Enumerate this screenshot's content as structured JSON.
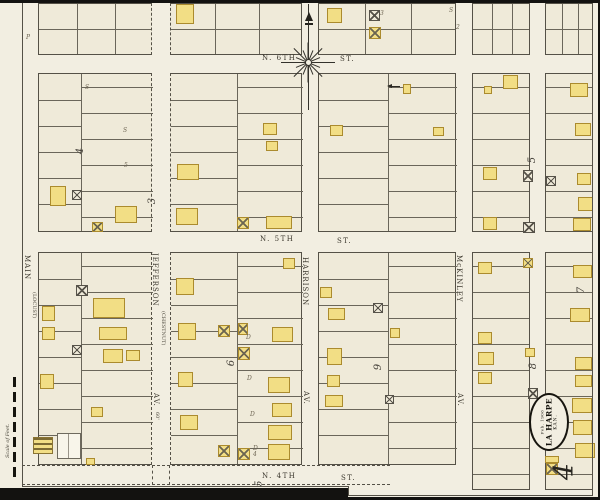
{
  "map_type": "sanborn-fire-insurance-plat",
  "stamp": {
    "date": "Feb. 1906",
    "city": "LA HARPE",
    "state": "KAN."
  },
  "sheet_number": "4",
  "adjoining_sheet_number": "5",
  "scale_label": "Scale of Feet.",
  "streets": {
    "horizontal": [
      "N. 6th St.",
      "N. 5th St.",
      "N. 4th St."
    ],
    "vertical": [
      "Main (Locust)",
      "Jefferson (Chestnut) Av. 60'",
      "Harrison Av.",
      "McKinley Av."
    ]
  },
  "block_numbers_visible": [
    "2",
    "3",
    "4",
    "5",
    "6",
    "7",
    "8",
    "9"
  ],
  "colors": {
    "paper": "#f2eee1",
    "block_fill": "#efead9",
    "line": "#555147",
    "building_yellow": "#f2de85",
    "building_border": "#ab8b2e",
    "ink": "#3b372d",
    "scan_edge": "#131210"
  },
  "labels": [
    {
      "t": "N. 6TH",
      "x": 262,
      "y": 55,
      "cls": "sh",
      "n": "street-label-n-6th"
    },
    {
      "t": "ST.",
      "x": 340,
      "y": 56,
      "cls": "sh",
      "n": "street-label-n-6th-st"
    },
    {
      "t": "N. 5TH",
      "x": 260,
      "y": 236,
      "cls": "sh",
      "n": "street-label-n-5th"
    },
    {
      "t": "ST.",
      "x": 337,
      "y": 238,
      "cls": "sh",
      "n": "street-label-n-5th-st"
    },
    {
      "t": "N. 4TH",
      "x": 262,
      "y": 473,
      "cls": "sh",
      "n": "street-label-n-4th"
    },
    {
      "t": "ST.",
      "x": 341,
      "y": 475,
      "cls": "sh",
      "n": "street-label-n-4th-st"
    },
    {
      "t": "MAIN",
      "x": 23,
      "y": 255,
      "cls": "sv",
      "n": "street-label-main"
    },
    {
      "t": "(LOCUST)",
      "x": 31,
      "y": 292,
      "cls": "sv alt",
      "n": "street-label-main-former"
    },
    {
      "t": "JEFFERSON",
      "x": 151,
      "y": 253,
      "cls": "sv",
      "n": "street-label-jefferson"
    },
    {
      "t": "(CHESTNUT)",
      "x": 160,
      "y": 311,
      "cls": "sv alt",
      "n": "street-label-jefferson-former"
    },
    {
      "t": "AV.",
      "x": 152,
      "y": 393,
      "cls": "sv",
      "n": "street-label-jefferson-av"
    },
    {
      "t": "60'",
      "x": 154,
      "y": 412,
      "cls": "sv alt",
      "n": "street-width-60ft"
    },
    {
      "t": "HARRISON",
      "x": 301,
      "y": 257,
      "cls": "sv",
      "n": "street-label-harrison"
    },
    {
      "t": "AV.",
      "x": 302,
      "y": 391,
      "cls": "sv",
      "n": "street-label-harrison-av"
    },
    {
      "t": "McKINLEY",
      "x": 455,
      "y": 255,
      "cls": "sv",
      "n": "street-label-mckinley"
    },
    {
      "t": "AV.",
      "x": 456,
      "y": 393,
      "cls": "sv",
      "n": "street-label-mckinley-av"
    },
    {
      "t": "4",
      "x": 78,
      "y": 146,
      "cls": "bn",
      "n": "block-number-4"
    },
    {
      "t": "3",
      "x": 150,
      "y": 196,
      "cls": "bn",
      "n": "block-number-3"
    },
    {
      "t": "5",
      "x": 530,
      "y": 155,
      "cls": "bn",
      "n": "block-number-5"
    },
    {
      "t": "6",
      "x": 229,
      "y": 358,
      "cls": "bn",
      "n": "block-number-6"
    },
    {
      "t": "9",
      "x": 376,
      "y": 362,
      "cls": "bn",
      "n": "block-number-9"
    },
    {
      "t": "7",
      "x": 579,
      "y": 285,
      "cls": "bn",
      "n": "block-number-7"
    },
    {
      "t": "8",
      "x": 531,
      "y": 361,
      "cls": "bn",
      "n": "block-number-8"
    },
    {
      "t": "S",
      "x": 85,
      "y": 85,
      "cls": "an",
      "n": "lot-letter-s"
    },
    {
      "t": "S",
      "x": 123,
      "y": 128,
      "cls": "an",
      "n": "lot-letter-s"
    },
    {
      "t": "S",
      "x": 449,
      "y": 8,
      "cls": "an",
      "n": "lot-letter-s"
    },
    {
      "t": "P",
      "x": 26,
      "y": 35,
      "cls": "an",
      "n": "lot-letter-p"
    },
    {
      "t": "D",
      "x": 246,
      "y": 335,
      "cls": "an",
      "n": "dwelling-mark"
    },
    {
      "t": "D",
      "x": 247,
      "y": 376,
      "cls": "an",
      "n": "dwelling-mark"
    },
    {
      "t": "D",
      "x": 250,
      "y": 412,
      "cls": "an",
      "n": "dwelling-mark"
    },
    {
      "t": "D",
      "x": 253,
      "y": 446,
      "cls": "an",
      "n": "dwelling-mark"
    },
    {
      "t": "3",
      "x": 380,
      "y": 11,
      "cls": "an",
      "n": "lot-number"
    },
    {
      "t": "2",
      "x": 456,
      "y": 25,
      "cls": "an",
      "n": "lot-number"
    },
    {
      "t": "4",
      "x": 253,
      "y": 452,
      "cls": "an",
      "n": "lot-number"
    },
    {
      "t": "5",
      "x": 124,
      "y": 163,
      "cls": "an",
      "n": "lot-number"
    }
  ],
  "blocks": [
    {
      "x": 38,
      "y": 3,
      "w": 114,
      "h": 52,
      "kind": "top",
      "dr": true
    },
    {
      "x": 170,
      "y": 3,
      "w": 132,
      "h": 52,
      "kind": "top",
      "dl": true
    },
    {
      "x": 318,
      "y": 3,
      "w": 138,
      "h": 52,
      "kind": "top"
    },
    {
      "x": 472,
      "y": 3,
      "w": 58,
      "h": 52,
      "kind": "top"
    },
    {
      "x": 545,
      "y": 3,
      "w": 48,
      "h": 52,
      "kind": "top"
    },
    {
      "x": 38,
      "y": 73,
      "w": 114,
      "h": 159,
      "kind": "tall",
      "alley": true,
      "ax": 42,
      "dr": true
    },
    {
      "x": 170,
      "y": 73,
      "w": 132,
      "h": 159,
      "kind": "tall",
      "alley": true,
      "dl": true
    },
    {
      "x": 318,
      "y": 73,
      "w": 138,
      "h": 159,
      "kind": "tall",
      "alley": true
    },
    {
      "x": 472,
      "y": 73,
      "w": 58,
      "h": 159,
      "kind": "tall"
    },
    {
      "x": 545,
      "y": 73,
      "w": 48,
      "h": 159,
      "kind": "tall"
    },
    {
      "x": 38,
      "y": 252,
      "w": 114,
      "h": 213,
      "kind": "tall",
      "alley": true,
      "ax": 42,
      "dr": true
    },
    {
      "x": 170,
      "y": 252,
      "w": 132,
      "h": 213,
      "kind": "tall",
      "alley": true,
      "dl": true
    },
    {
      "x": 318,
      "y": 252,
      "w": 138,
      "h": 213,
      "kind": "tall",
      "alley": true
    },
    {
      "x": 472,
      "y": 252,
      "w": 58,
      "h": 238,
      "kind": "tall"
    },
    {
      "x": 545,
      "y": 252,
      "w": 48,
      "h": 238,
      "kind": "tall"
    }
  ],
  "buildings": [
    [
      176,
      4,
      18,
      20,
      "f"
    ],
    [
      327,
      8,
      15,
      15,
      "f"
    ],
    [
      369,
      10,
      11,
      11,
      "xb"
    ],
    [
      369,
      27,
      12,
      12,
      "fx"
    ],
    [
      50,
      186,
      16,
      20,
      "f"
    ],
    [
      72,
      190,
      10,
      10,
      "xb"
    ],
    [
      92,
      222,
      11,
      10,
      "fx"
    ],
    [
      115,
      206,
      22,
      17,
      "f"
    ],
    [
      177,
      164,
      22,
      16,
      "f"
    ],
    [
      176,
      208,
      22,
      17,
      "f"
    ],
    [
      263,
      123,
      14,
      12,
      "f"
    ],
    [
      266,
      141,
      12,
      10,
      "f"
    ],
    [
      237,
      217,
      12,
      12,
      "fx"
    ],
    [
      266,
      216,
      26,
      13,
      "f"
    ],
    [
      330,
      125,
      13,
      11,
      "f"
    ],
    [
      403,
      84,
      8,
      10,
      "f"
    ],
    [
      433,
      127,
      11,
      9,
      "f"
    ],
    [
      483,
      167,
      14,
      13,
      "f"
    ],
    [
      483,
      217,
      14,
      13,
      "f"
    ],
    [
      503,
      75,
      15,
      14,
      "f"
    ],
    [
      484,
      86,
      8,
      8,
      "f"
    ],
    [
      523,
      170,
      10,
      12,
      "xb"
    ],
    [
      523,
      222,
      12,
      11,
      "xb"
    ],
    [
      546,
      176,
      10,
      10,
      "xb"
    ],
    [
      575,
      123,
      16,
      13,
      "f"
    ],
    [
      577,
      173,
      14,
      12,
      "f"
    ],
    [
      578,
      197,
      15,
      14,
      "f"
    ],
    [
      573,
      218,
      18,
      13,
      "f"
    ],
    [
      570,
      83,
      18,
      14,
      "f"
    ],
    [
      76,
      285,
      12,
      11,
      "xb"
    ],
    [
      93,
      298,
      32,
      20,
      "f"
    ],
    [
      99,
      327,
      28,
      13,
      "f"
    ],
    [
      103,
      349,
      20,
      14,
      "f"
    ],
    [
      126,
      350,
      14,
      11,
      "f"
    ],
    [
      42,
      306,
      13,
      15,
      "f"
    ],
    [
      42,
      327,
      13,
      13,
      "f"
    ],
    [
      40,
      374,
      14,
      15,
      "f"
    ],
    [
      72,
      345,
      10,
      10,
      "xb"
    ],
    [
      91,
      407,
      12,
      10,
      "f"
    ],
    [
      86,
      458,
      9,
      7,
      "f"
    ],
    [
      33,
      437,
      20,
      17,
      "sp"
    ],
    [
      57,
      433,
      24,
      26,
      "wo"
    ],
    [
      176,
      278,
      18,
      17,
      "f"
    ],
    [
      178,
      323,
      18,
      17,
      "f"
    ],
    [
      178,
      372,
      15,
      15,
      "f"
    ],
    [
      180,
      415,
      18,
      15,
      "f"
    ],
    [
      218,
      325,
      12,
      12,
      "fx"
    ],
    [
      238,
      323,
      10,
      12,
      "fx"
    ],
    [
      238,
      347,
      12,
      13,
      "fx"
    ],
    [
      272,
      327,
      21,
      15,
      "f"
    ],
    [
      268,
      377,
      22,
      16,
      "f"
    ],
    [
      272,
      403,
      20,
      14,
      "f"
    ],
    [
      268,
      425,
      24,
      15,
      "f"
    ],
    [
      218,
      445,
      12,
      12,
      "fx"
    ],
    [
      238,
      448,
      12,
      12,
      "fx"
    ],
    [
      268,
      444,
      22,
      16,
      "f"
    ],
    [
      283,
      258,
      12,
      11,
      "f"
    ],
    [
      320,
      287,
      12,
      11,
      "f"
    ],
    [
      328,
      308,
      17,
      12,
      "f"
    ],
    [
      327,
      348,
      15,
      17,
      "f"
    ],
    [
      327,
      375,
      13,
      12,
      "f"
    ],
    [
      325,
      395,
      18,
      12,
      "f"
    ],
    [
      373,
      303,
      10,
      10,
      "xb"
    ],
    [
      390,
      328,
      10,
      10,
      "f"
    ],
    [
      385,
      395,
      9,
      9,
      "xb"
    ],
    [
      478,
      262,
      14,
      12,
      "f"
    ],
    [
      478,
      332,
      14,
      12,
      "f"
    ],
    [
      478,
      352,
      16,
      13,
      "f"
    ],
    [
      478,
      372,
      14,
      12,
      "f"
    ],
    [
      523,
      258,
      10,
      10,
      "fx"
    ],
    [
      525,
      348,
      10,
      9,
      "f"
    ],
    [
      528,
      388,
      10,
      11,
      "xb"
    ],
    [
      546,
      463,
      12,
      12,
      "fx"
    ],
    [
      545,
      456,
      14,
      7,
      "f"
    ],
    [
      573,
      265,
      19,
      13,
      "f"
    ],
    [
      570,
      308,
      20,
      14,
      "f"
    ],
    [
      575,
      357,
      17,
      13,
      "f"
    ],
    [
      575,
      375,
      17,
      12,
      "f"
    ],
    [
      572,
      398,
      20,
      15,
      "f"
    ],
    [
      573,
      420,
      19,
      15,
      "f"
    ],
    [
      575,
      443,
      20,
      15,
      "f"
    ]
  ]
}
